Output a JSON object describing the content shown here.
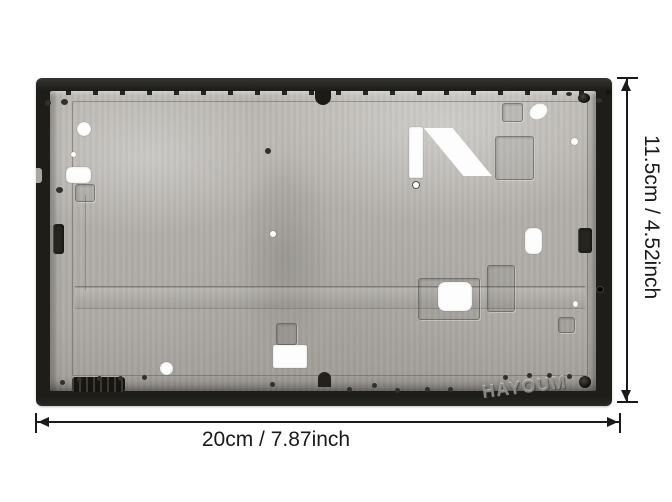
{
  "page": {
    "type": "product-dimension-photo",
    "product_name": "black metal frame chassis"
  },
  "annotations": {
    "height_label": "11.5cm / 4.52inch",
    "width_label": "20cm / 7.87inch"
  },
  "watermark": {
    "text": "HAYOUM"
  },
  "icons": {
    "height_arrows": "vertical double-headed dimension arrow",
    "width_arrows": "horizontal double-headed dimension arrow"
  },
  "colors": {
    "background": "#ffffff",
    "frame_black": "#1e1d1a",
    "metal_gray": "#b3b0ab",
    "annotation_line": "#1a1a1a",
    "watermark_gray": "#918e89"
  }
}
